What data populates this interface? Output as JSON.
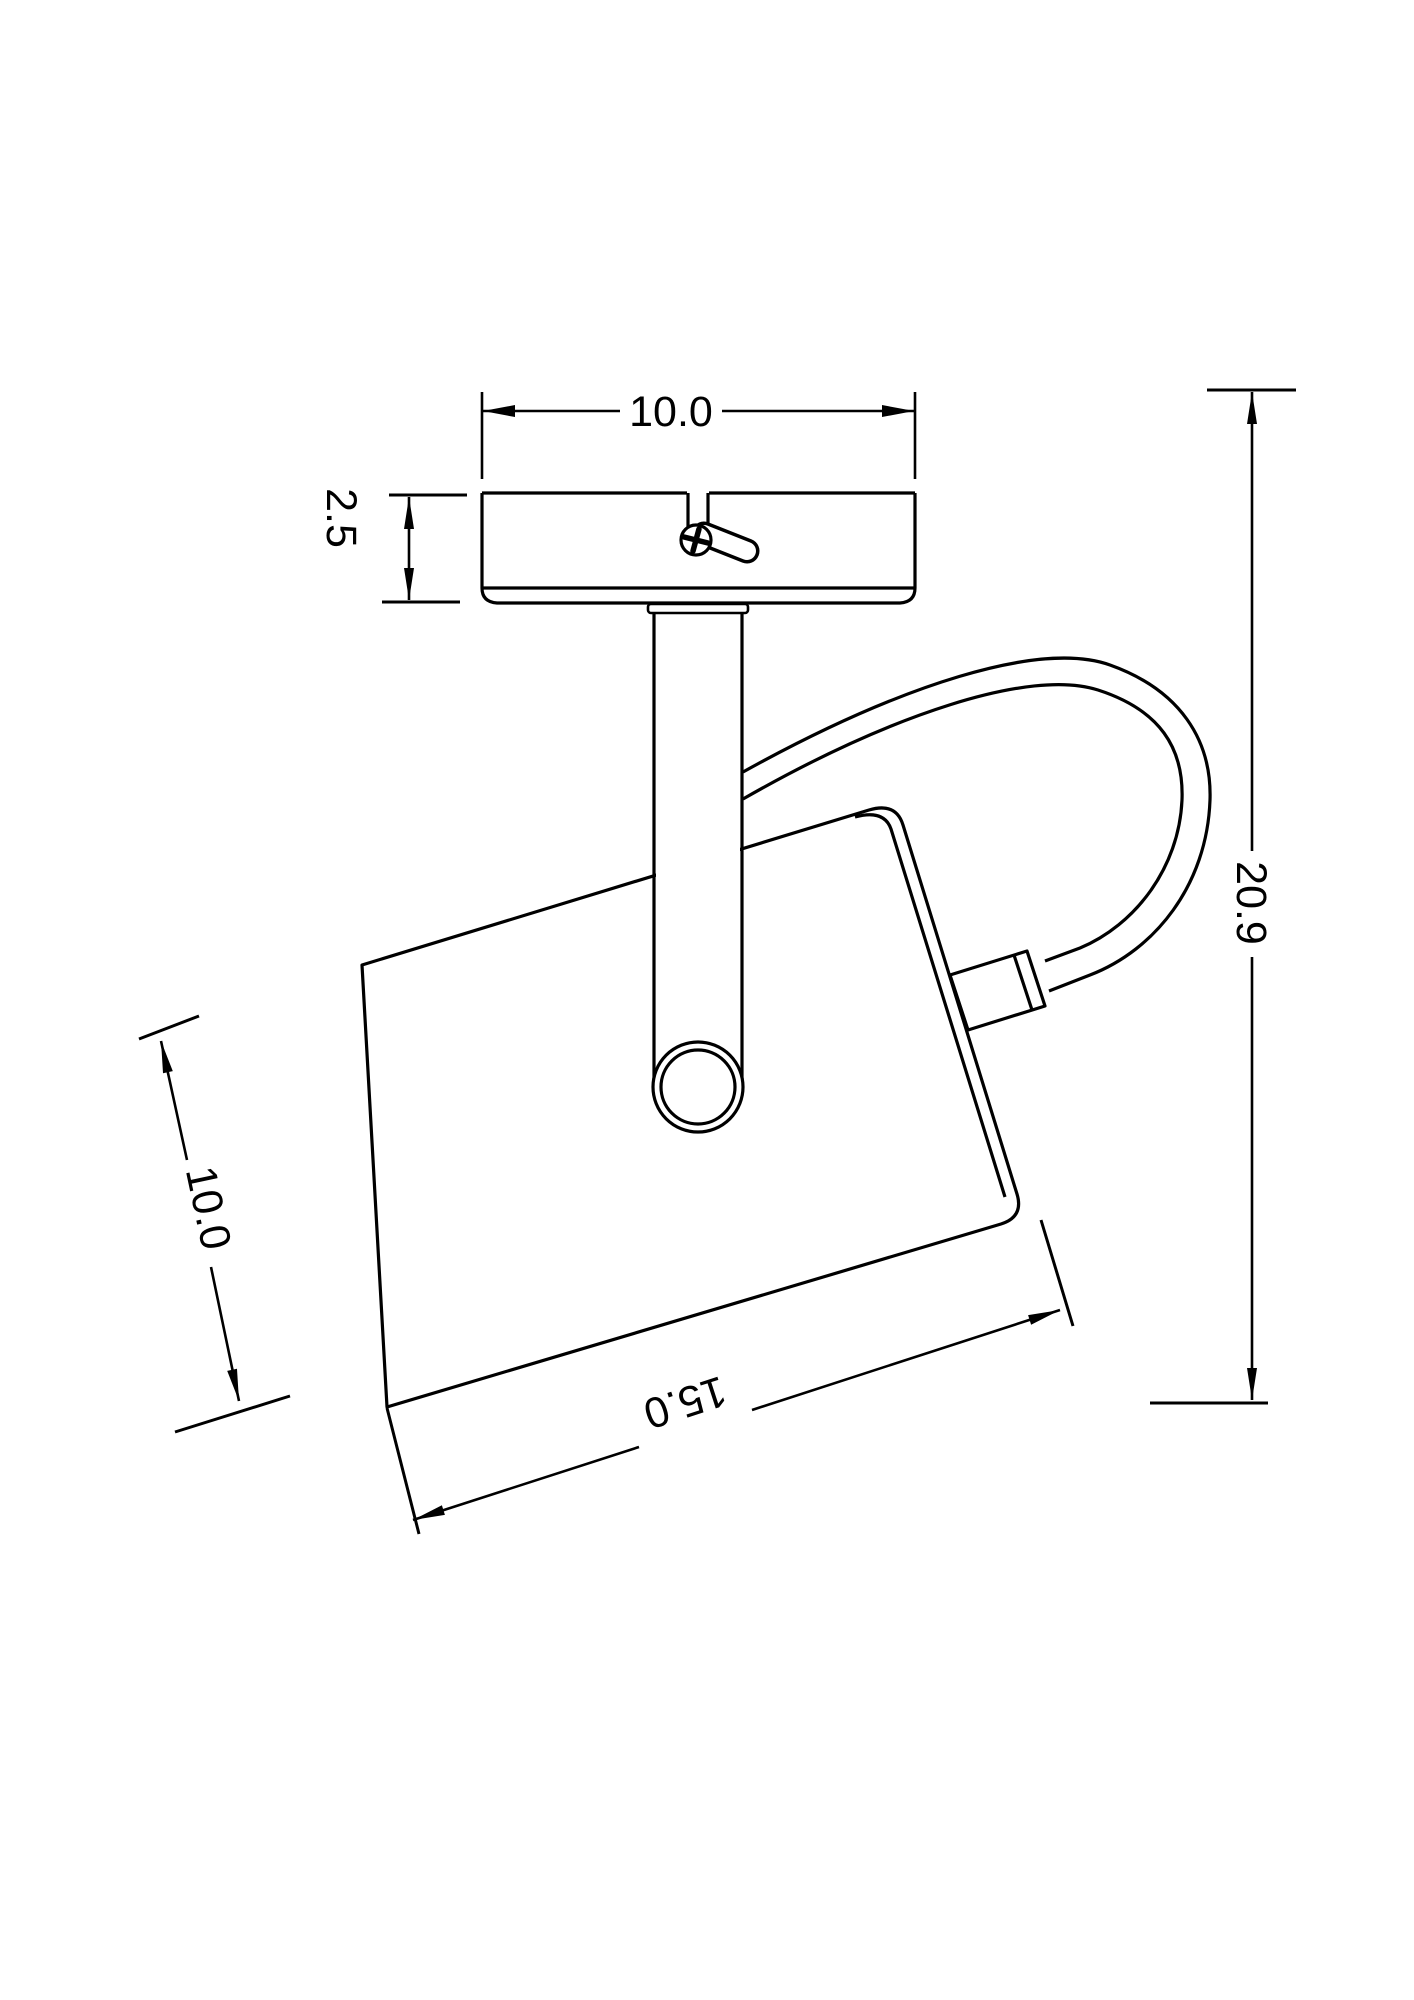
{
  "drawing": {
    "type": "technical-dimension-drawing",
    "subject": "ceiling-spotlight-side-view",
    "colors": {
      "line": "#000000",
      "background": "#ffffff"
    },
    "dimensions": {
      "plate_width": "10.0",
      "plate_thickness": "2.5",
      "overall_height": "20.9",
      "head_length": "15.0",
      "head_depth": "10.0"
    }
  }
}
